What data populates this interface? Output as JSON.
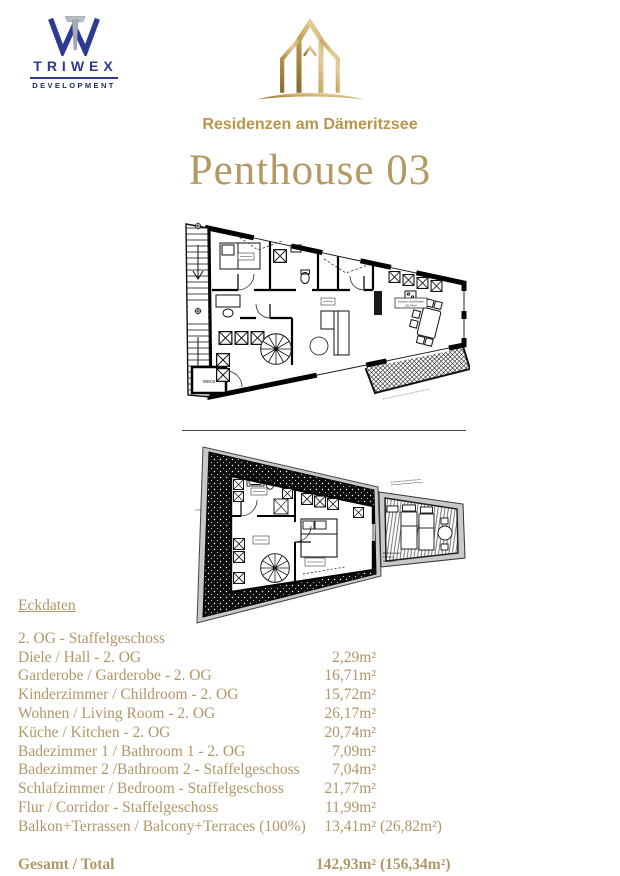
{
  "header": {
    "triwex": {
      "name": "TRIWEX",
      "subtitle": "DEVELOPMENT"
    },
    "residence_name": "Residenzen am Dämeritzsee"
  },
  "title": "Penthouse 03",
  "plans": {
    "level1": {
      "unit_label": "WE03",
      "kitchen_label_line1": "Kochen und Essen",
      "kitchen_label_line2": "20,74m²"
    },
    "level2": {
      "terrace_label_line1": "Dachterrasse",
      "terrace_label_line2": "13,41m²",
      "terrace_label_line3": "(26,82m²)"
    }
  },
  "eckdaten": {
    "heading": "Eckdaten",
    "section": "2. OG - Staffelgeschoss",
    "rows": [
      {
        "label": "Diele / Hall - 2. OG",
        "value": "2,29m²",
        "extra": ""
      },
      {
        "label": "Garderobe / Garderobe - 2. OG",
        "value": "16,71m²",
        "extra": ""
      },
      {
        "label": "Kinderzimmer / Childroom - 2. OG",
        "value": "15,72m²",
        "extra": ""
      },
      {
        "label": "Wohnen / Living Room  - 2. OG",
        "value": "26,17m²",
        "extra": ""
      },
      {
        "label": "Küche / Kitchen - 2. OG",
        "value": "20,74m²",
        "extra": ""
      },
      {
        "label": "Badezimmer 1 / Bathroom 1 - 2. OG",
        "value": "7,09m²",
        "extra": ""
      },
      {
        "label": "Badezimmer 2 /Bathroom 2 - Staffelgeschoss",
        "value": "7,04m²",
        "extra": ""
      },
      {
        "label": "Schlafzimmer / Bedroom - Staffelgeschoss",
        "value": "21,77m²",
        "extra": ""
      },
      {
        "label": "Flur / Corridor - Staffelgeschoss",
        "value": "11,99m²",
        "extra": ""
      },
      {
        "label": "Balkon+Terrassen / Balcony+Terraces (100%)",
        "value": "13,41m²",
        "extra": "(26,82m²)"
      }
    ],
    "total": {
      "label": "Gesamt / Total",
      "value": "142,93m²",
      "extra": "(156,34m²)"
    }
  },
  "colors": {
    "gold_text": "#b09768",
    "logo_gold": "#b8954a",
    "triwex_blue": "#2d3a92",
    "triwex_navy": "#1a2a5c"
  }
}
